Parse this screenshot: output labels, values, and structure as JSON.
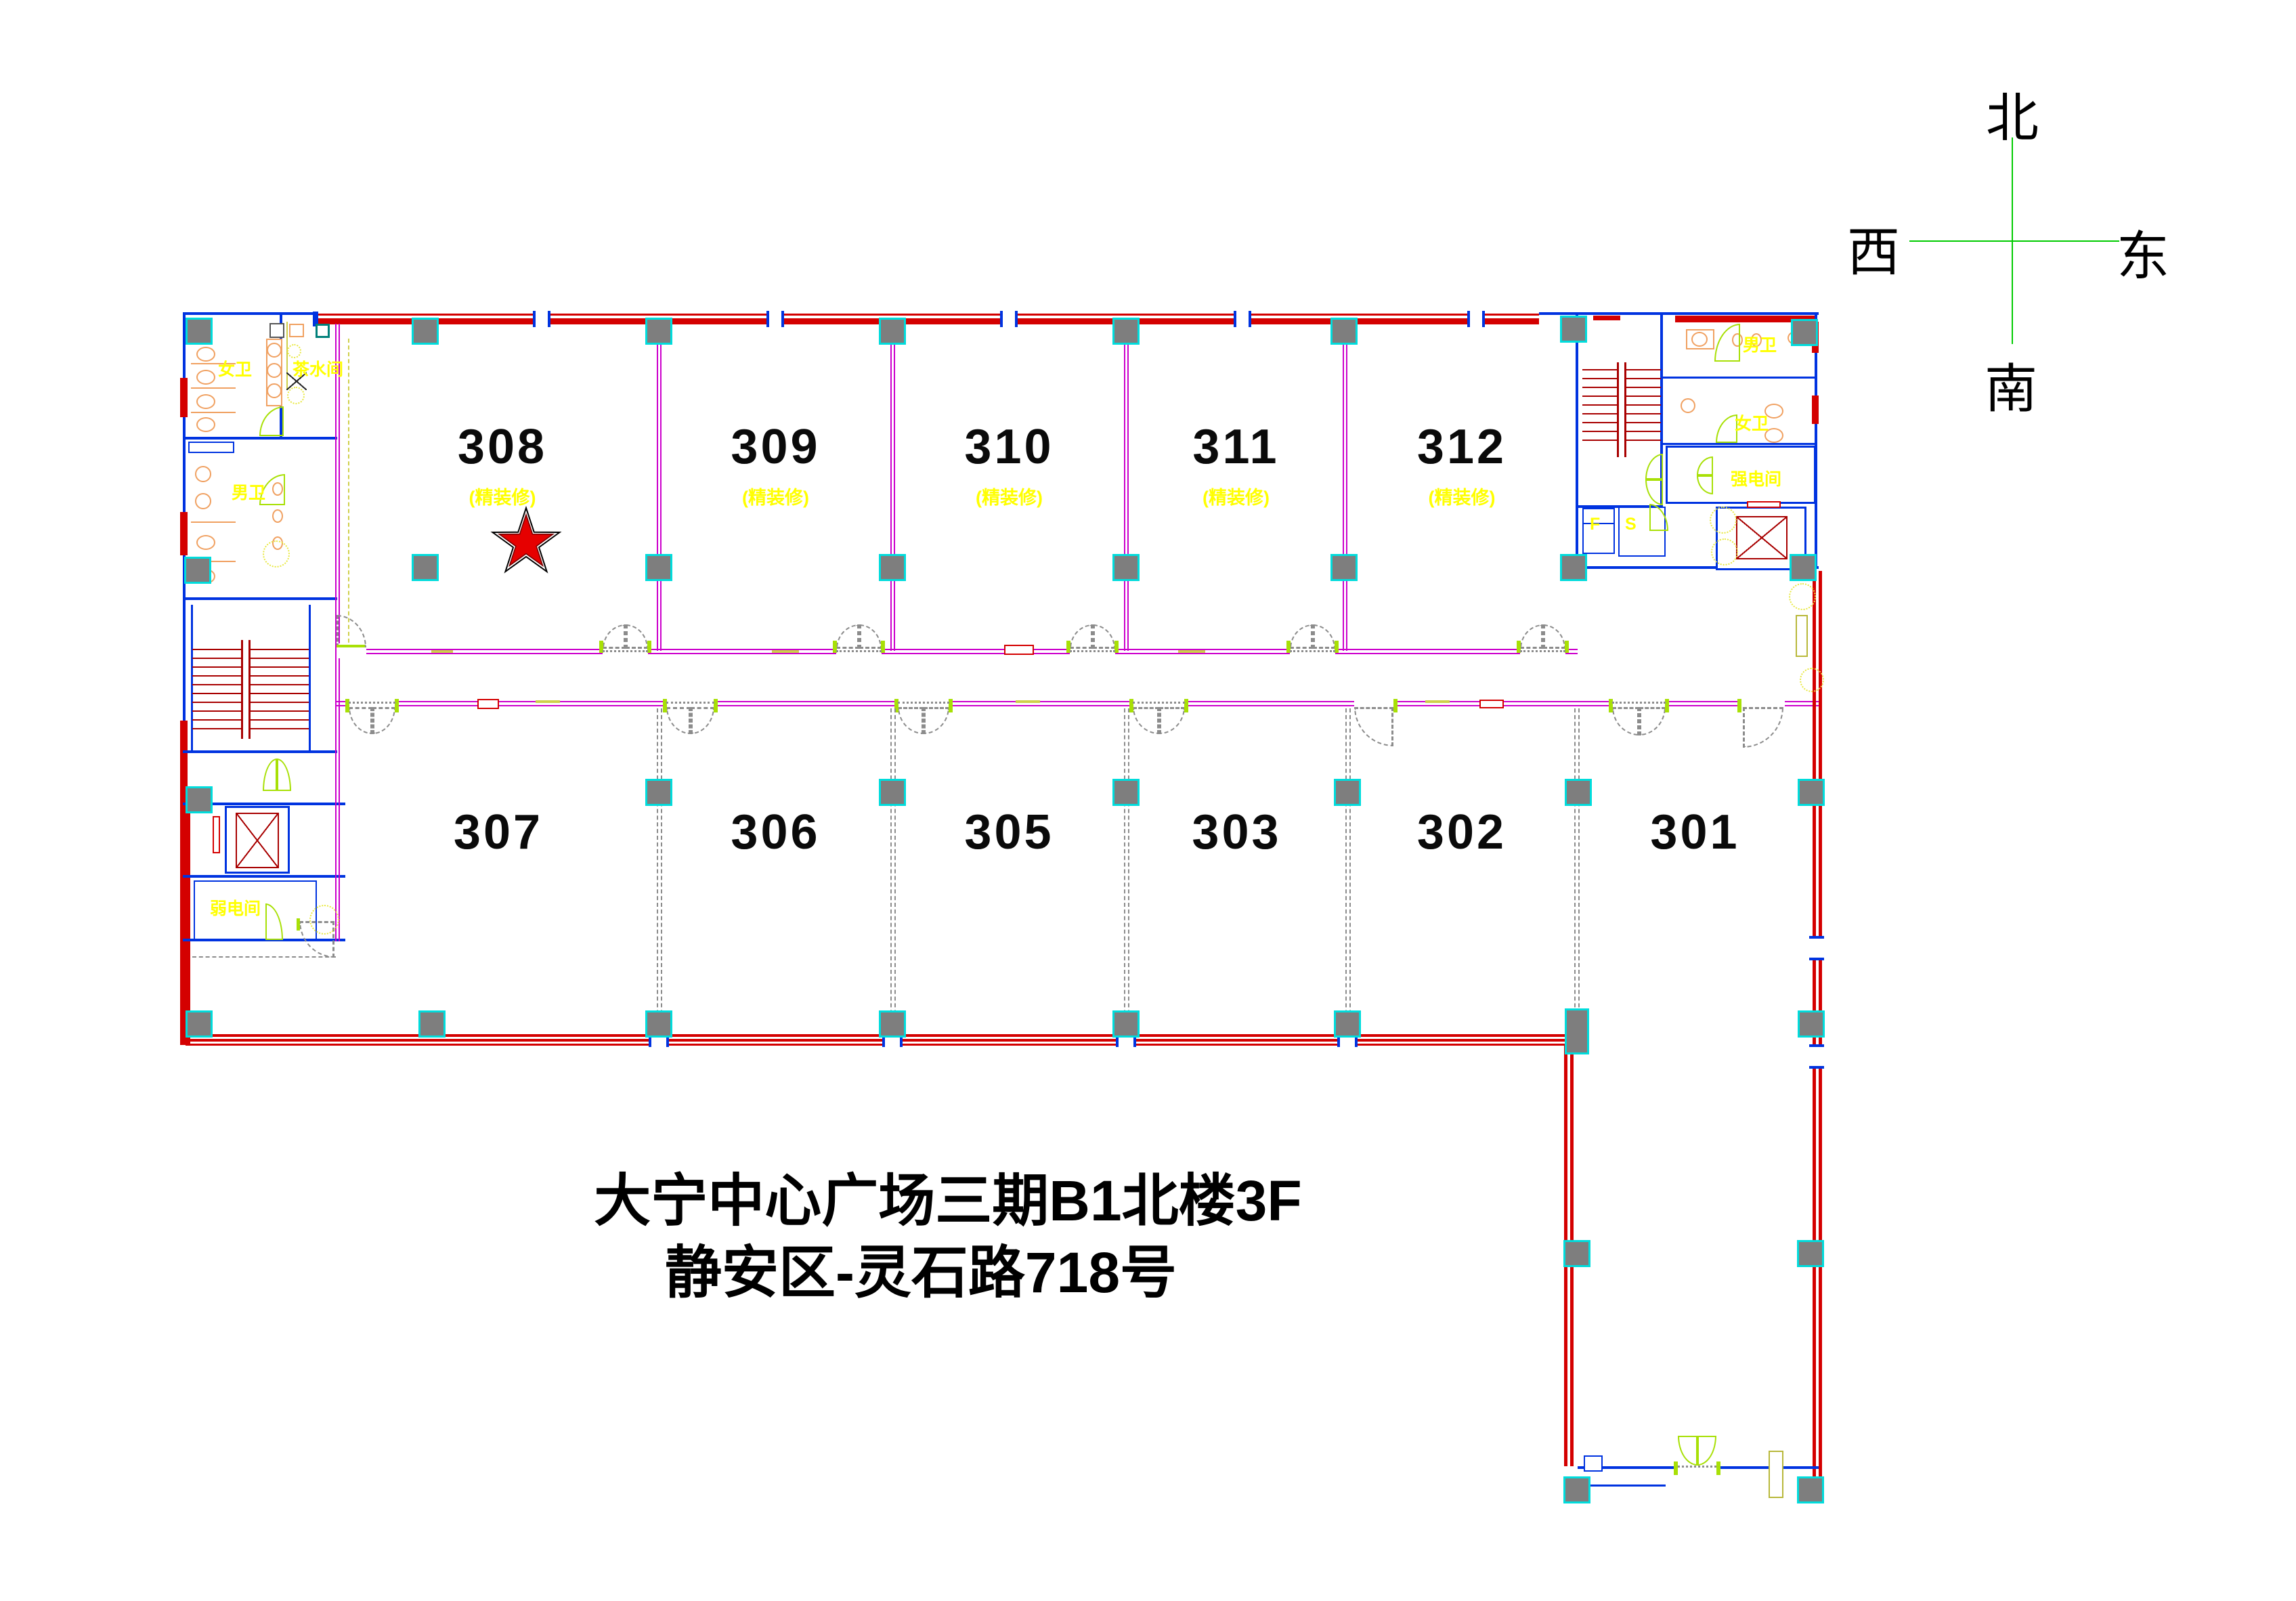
{
  "title": {
    "line1": "大宁中心广场三期B1北楼3F",
    "line2": "静安区-灵石路718号"
  },
  "compass": {
    "north": "北",
    "south": "南",
    "west": "西",
    "east": "东"
  },
  "rooms": {
    "top": [
      {
        "number": "308",
        "note": "(精装修)",
        "starred": true
      },
      {
        "number": "309",
        "note": "(精装修)",
        "starred": false
      },
      {
        "number": "310",
        "note": "(精装修)",
        "starred": false
      },
      {
        "number": "311",
        "note": "(精装修)",
        "starred": false
      },
      {
        "number": "312",
        "note": "(精装修)",
        "starred": false
      }
    ],
    "bottom": [
      {
        "number": "307"
      },
      {
        "number": "306"
      },
      {
        "number": "305"
      },
      {
        "number": "303"
      },
      {
        "number": "302"
      },
      {
        "number": "301"
      }
    ]
  },
  "cores": {
    "left": {
      "female_wc": "女卫",
      "tea_room": "茶水间",
      "male_wc": "男卫",
      "low_voltage_room": "弱电间"
    },
    "right": {
      "male_wc": "男卫",
      "female_wc": "女卫",
      "power_room": "强电间",
      "label_f": "F",
      "label_s": "S"
    }
  },
  "marker": {
    "type": "red-star",
    "room": "308"
  },
  "colors": {
    "outer_wall_red": "#d40000",
    "core_wall_blue": "#0033e0",
    "partition_magenta": "#cc00cc",
    "door_green": "#a8e006",
    "label_yellow": "#ffff00",
    "column_gray": "#7e7e7e",
    "column_edge_cyan": "#00dcdc",
    "stair_dark_red": "#a80000",
    "fixture_orange": "#f0a060",
    "compass_green": "#00cc00",
    "star_red": "#e60000"
  }
}
